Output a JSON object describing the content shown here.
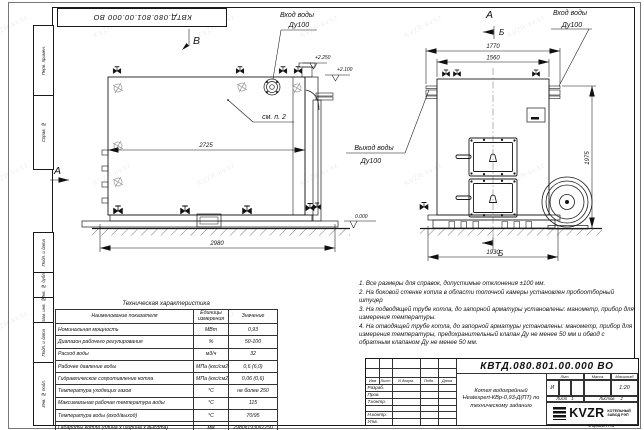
{
  "watermark": {
    "text": "KVZR-kv.kz"
  },
  "frame": {
    "top_stamp": "КВТД.080.801.00.000 ВО",
    "left_margin_labels": [
      "Перв. примен.",
      "Справ. №",
      "Подп. и дата",
      "Инв. № дубл.",
      "Взам. инв. №",
      "Подп. и дата",
      "Инв. № подл."
    ],
    "format_label": "Формат А3"
  },
  "views": {
    "side_view": {
      "label": "В",
      "section_label": "А",
      "inlet_line1": "Вход воды",
      "inlet_line2": "Ду100",
      "see_note": "см. п. 2",
      "dim_inner": "2725",
      "dim_total": "2980",
      "elev_top": "+2.250",
      "elev_mid": "+2.100",
      "elev_zero": "0.000"
    },
    "front_view": {
      "label": "А",
      "section_top": "Б",
      "section_bottom": "Б",
      "inlet_line1": "Вход воды",
      "inlet_line2": "Ду100",
      "outlet_line1": "Выход воды",
      "outlet_line2": "Ду100",
      "dim_outer": "1770",
      "dim_inner": "1560",
      "dim_height": "1975",
      "dim_bottom": "1930"
    }
  },
  "notes": {
    "items": [
      "1. Все размеры для справок, допустимые отклонения ±100 мм.",
      "2. На боковой стенке котла в области топочной камеры установлен пробоотборный штуцер",
      "3. На подводящей трубе котла, до запорной арматуры установлены: манометр, прибор для измерения температуры.",
      "4. На отводящей трубе котла, до запорной арматуры установлены: манометр, прибор для измерения температуры, предохранительный клапан Ду не менее 50 мм и обвод с обратным клапаном Ду не менее 50 мм."
    ]
  },
  "tech_table": {
    "title": "Техническая характеристика",
    "headers": [
      "Наименование показателя",
      "Единицы измерения",
      "Значение"
    ],
    "rows": [
      [
        "Номинальная мощность",
        "МВт",
        "0,93"
      ],
      [
        "Диапазон рабочего регулирования",
        "%",
        "50-100"
      ],
      [
        "Расход воды",
        "м3/ч",
        "32"
      ],
      [
        "Рабочее давление воды",
        "МПа (кгс/см2)",
        "0,6 (6,0)"
      ],
      [
        "Гидравлическое сопротивление котла",
        "МПа (кгс/см2)",
        "0,06 (0,6)"
      ],
      [
        "Температура уходящих газов",
        "°С",
        "не более 250"
      ],
      [
        "Максимальная рабочая температура воды",
        "°С",
        "115"
      ],
      [
        "Температура воды (вход/выход)",
        "°С",
        "70/95"
      ],
      [
        "Габариты котла (длина х ширина х высота)",
        "мм",
        "2980х1930х2250"
      ]
    ]
  },
  "title_block": {
    "doc_number": "КВТД.080.801.00.000 ВО",
    "change_header": [
      "Изм",
      "Лист",
      "N докум.",
      "Подп.",
      "Дата"
    ],
    "roles": [
      "Разраб.",
      "Пров.",
      "Т.контр.",
      "",
      "Н.контр.",
      "Утв."
    ],
    "name_lines": [
      "Котел водогрейный",
      "Heatexpert-КВр-0,93-Д(ПТ) по",
      "техническому заданию"
    ],
    "lit_label": "Лит.",
    "mass_label": "Масса",
    "scale_label": "Масштаб",
    "lit_value": "И",
    "scale_value": "1:20",
    "sheet_caption": "Лист",
    "sheet_value": "1",
    "sheets_caption": "Листов",
    "sheets_value": "2",
    "logo_text": "KVZR",
    "logo_sub1": "КОТЕЛЬНЫЙ",
    "logo_sub2": "ЗАВОД РЭП"
  }
}
